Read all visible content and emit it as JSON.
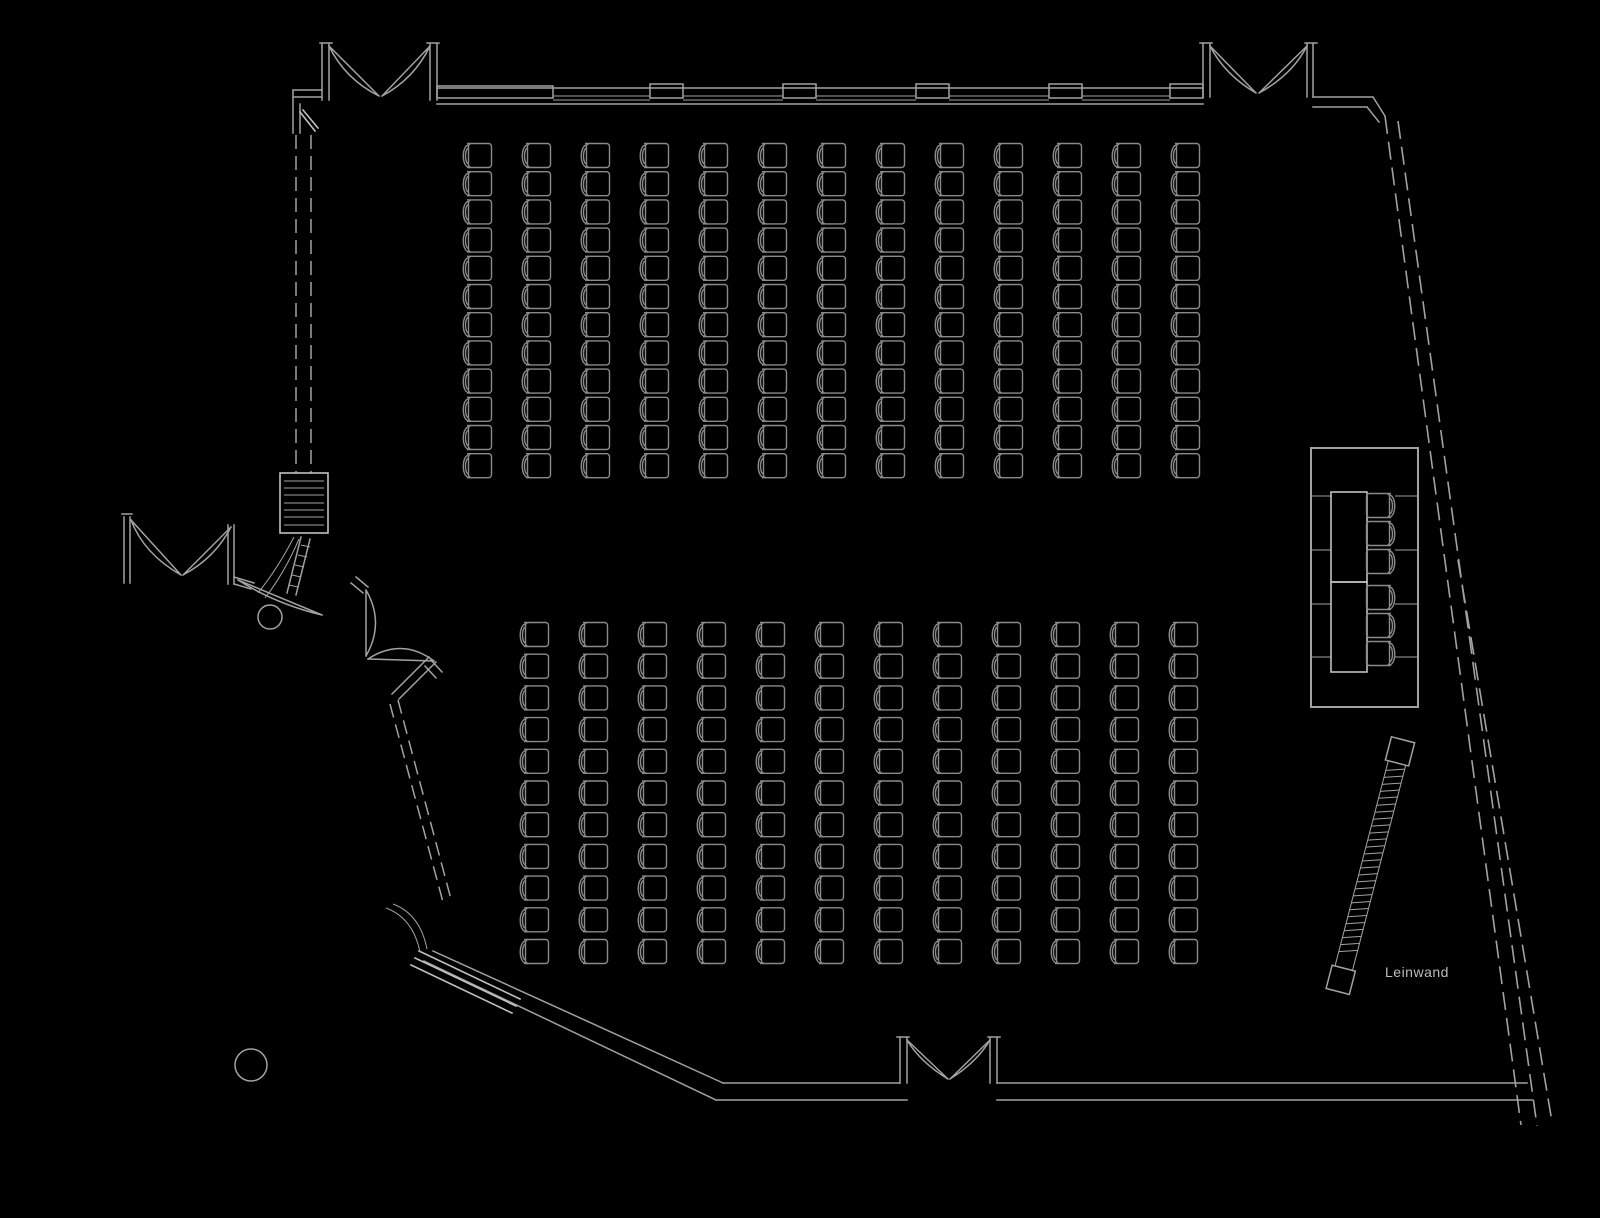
{
  "labels": {
    "screen": "Leinwand"
  },
  "colors": {
    "background": "#000000",
    "wall": "#a2a2a2",
    "wall_bright": "#c0c0c0",
    "seat": "#8a8a8a",
    "label_text": "#bdbdbd"
  },
  "plan": {
    "seating": {
      "top_block": {
        "columns": 13,
        "rows": 12,
        "origin_x": 458,
        "origin_y": 142,
        "col_pitch": 59,
        "row_pitch": 28.2,
        "seat_count": 156
      },
      "bottom_block": {
        "columns": 12,
        "rows": 11,
        "origin_x": 515,
        "origin_y": 621,
        "col_pitch": 59,
        "row_pitch": 31.7,
        "seat_count": 132
      },
      "total_audience_seats": 288,
      "orientation": "seats-face-right"
    },
    "head_table": {
      "platform": {
        "x": 1311,
        "y": 448,
        "w": 107,
        "h": 259
      },
      "tables": [
        {
          "x": 1331,
          "y": 492,
          "w": 36,
          "h": 90
        },
        {
          "x": 1331,
          "y": 582,
          "w": 36,
          "h": 90
        }
      ],
      "divider_ys": [
        496,
        550,
        604,
        657
      ],
      "chair_ys": [
        492,
        520,
        548,
        584,
        612,
        640
      ],
      "chair_count": 6
    },
    "screen": {
      "x": 1397,
      "y": 763,
      "angle_deg": 14.55,
      "length": 212,
      "width": 18,
      "rungs": 27,
      "rung_step": 7.2
    },
    "window_pillar_xs": [
      650,
      783,
      916,
      1049,
      1170
    ],
    "doors": [
      {
        "name": "double-door-top-left"
      },
      {
        "name": "double-door-top-right"
      },
      {
        "name": "double-door-bottom"
      },
      {
        "name": "double-door-left-entrance"
      },
      {
        "name": "double-door-left-lower"
      },
      {
        "name": "single-door-bottom-left"
      }
    ],
    "columns": [
      {
        "cx": 270,
        "cy": 617,
        "r": 12
      },
      {
        "cx": 251,
        "cy": 1065,
        "r": 16
      }
    ],
    "partition": {
      "track_x1": 296,
      "track_x2": 311,
      "track_y1": 135,
      "track_y2": 473,
      "stack_box": {
        "x": 280,
        "y": 473,
        "w": 48,
        "h": 60,
        "slats": 7
      }
    }
  }
}
